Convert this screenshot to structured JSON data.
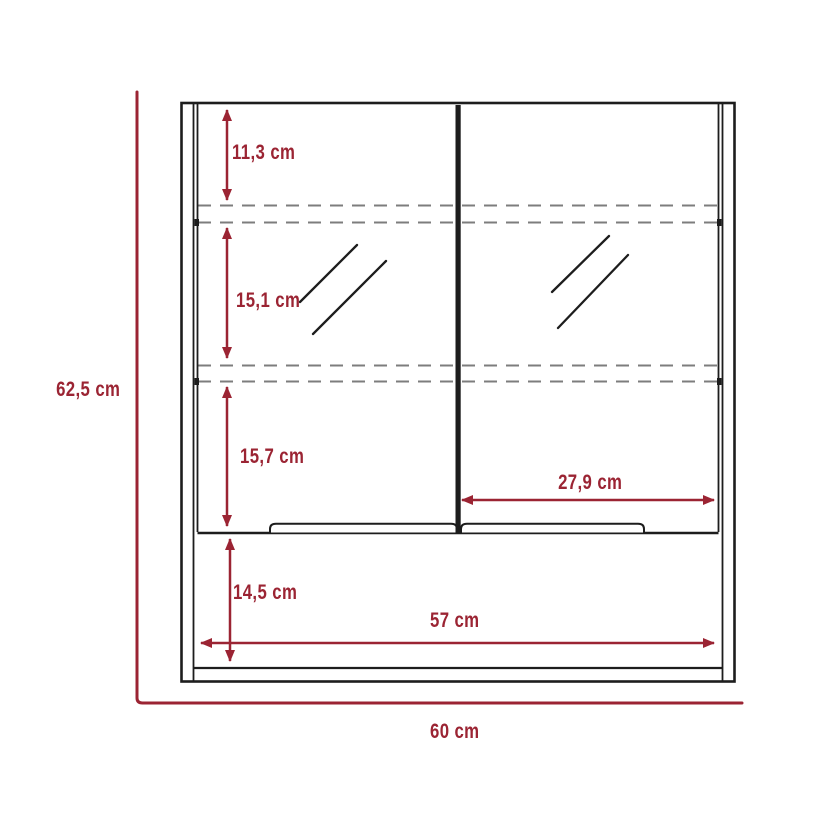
{
  "diagram": {
    "type": "furniture-dimension-drawing",
    "subject": "double-mirror-door wall cabinet, front elevation",
    "unit": "cm",
    "colors": {
      "dimension_red": "#9b2433",
      "outline_black": "#1d1d1d",
      "shelf_dash_gray": "#7d7d7d",
      "background": "#ffffff"
    },
    "dimensions": {
      "overall_height": {
        "label": "62,5 cm",
        "value": 62.5
      },
      "top_compartment": {
        "label": "11,3 cm",
        "value": 11.3
      },
      "middle_compartment": {
        "label": "15,1 cm",
        "value": 15.1
      },
      "lower_compartment": {
        "label": "15,7 cm",
        "value": 15.7
      },
      "open_shelf": {
        "label": "14,5 cm",
        "value": 14.5
      },
      "right_door_width": {
        "label": "27,9 cm",
        "value": 27.9
      },
      "interior_width": {
        "label": "57 cm",
        "value": 57
      },
      "overall_width": {
        "label": "60 cm",
        "value": 60
      }
    }
  }
}
